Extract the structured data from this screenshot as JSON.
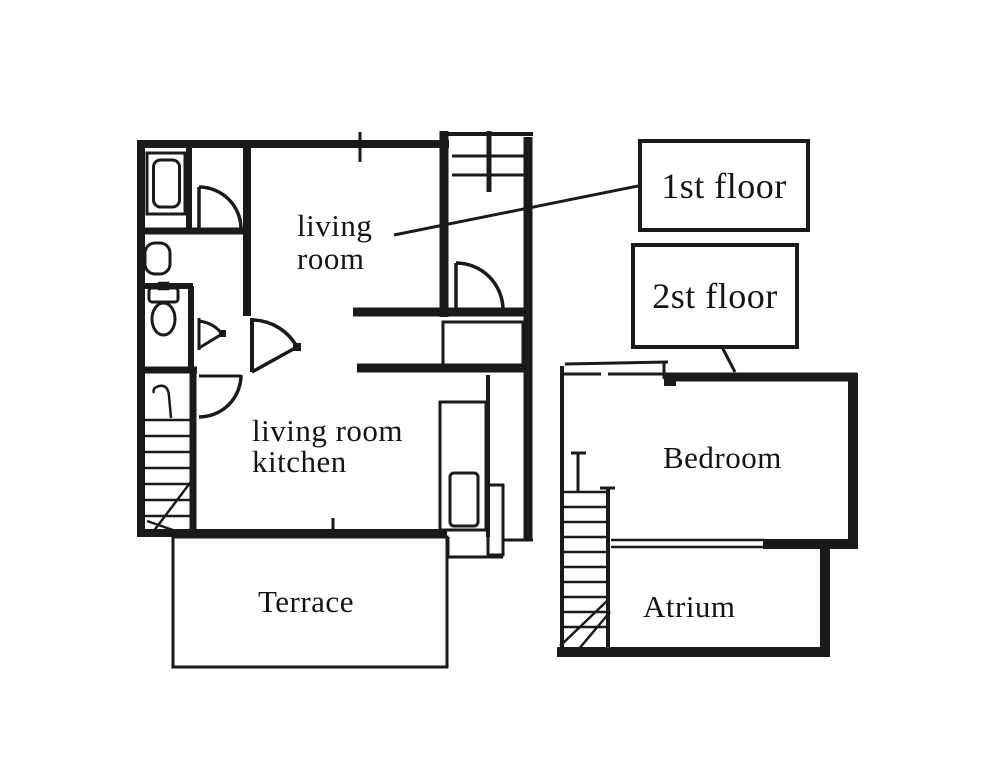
{
  "canvas": {
    "background": "#ffffff",
    "ink": "#1a1a1a"
  },
  "floor1": {
    "callout_label": "1st floor",
    "living_room_line1": "living",
    "living_room_line2": "room",
    "ldk_line1": "living room",
    "ldk_line2": "kitchen",
    "terrace_label": "Terrace"
  },
  "floor2": {
    "callout_label": "2st floor",
    "bedroom_label": "Bedroom",
    "atrium_label": "Atrium"
  }
}
